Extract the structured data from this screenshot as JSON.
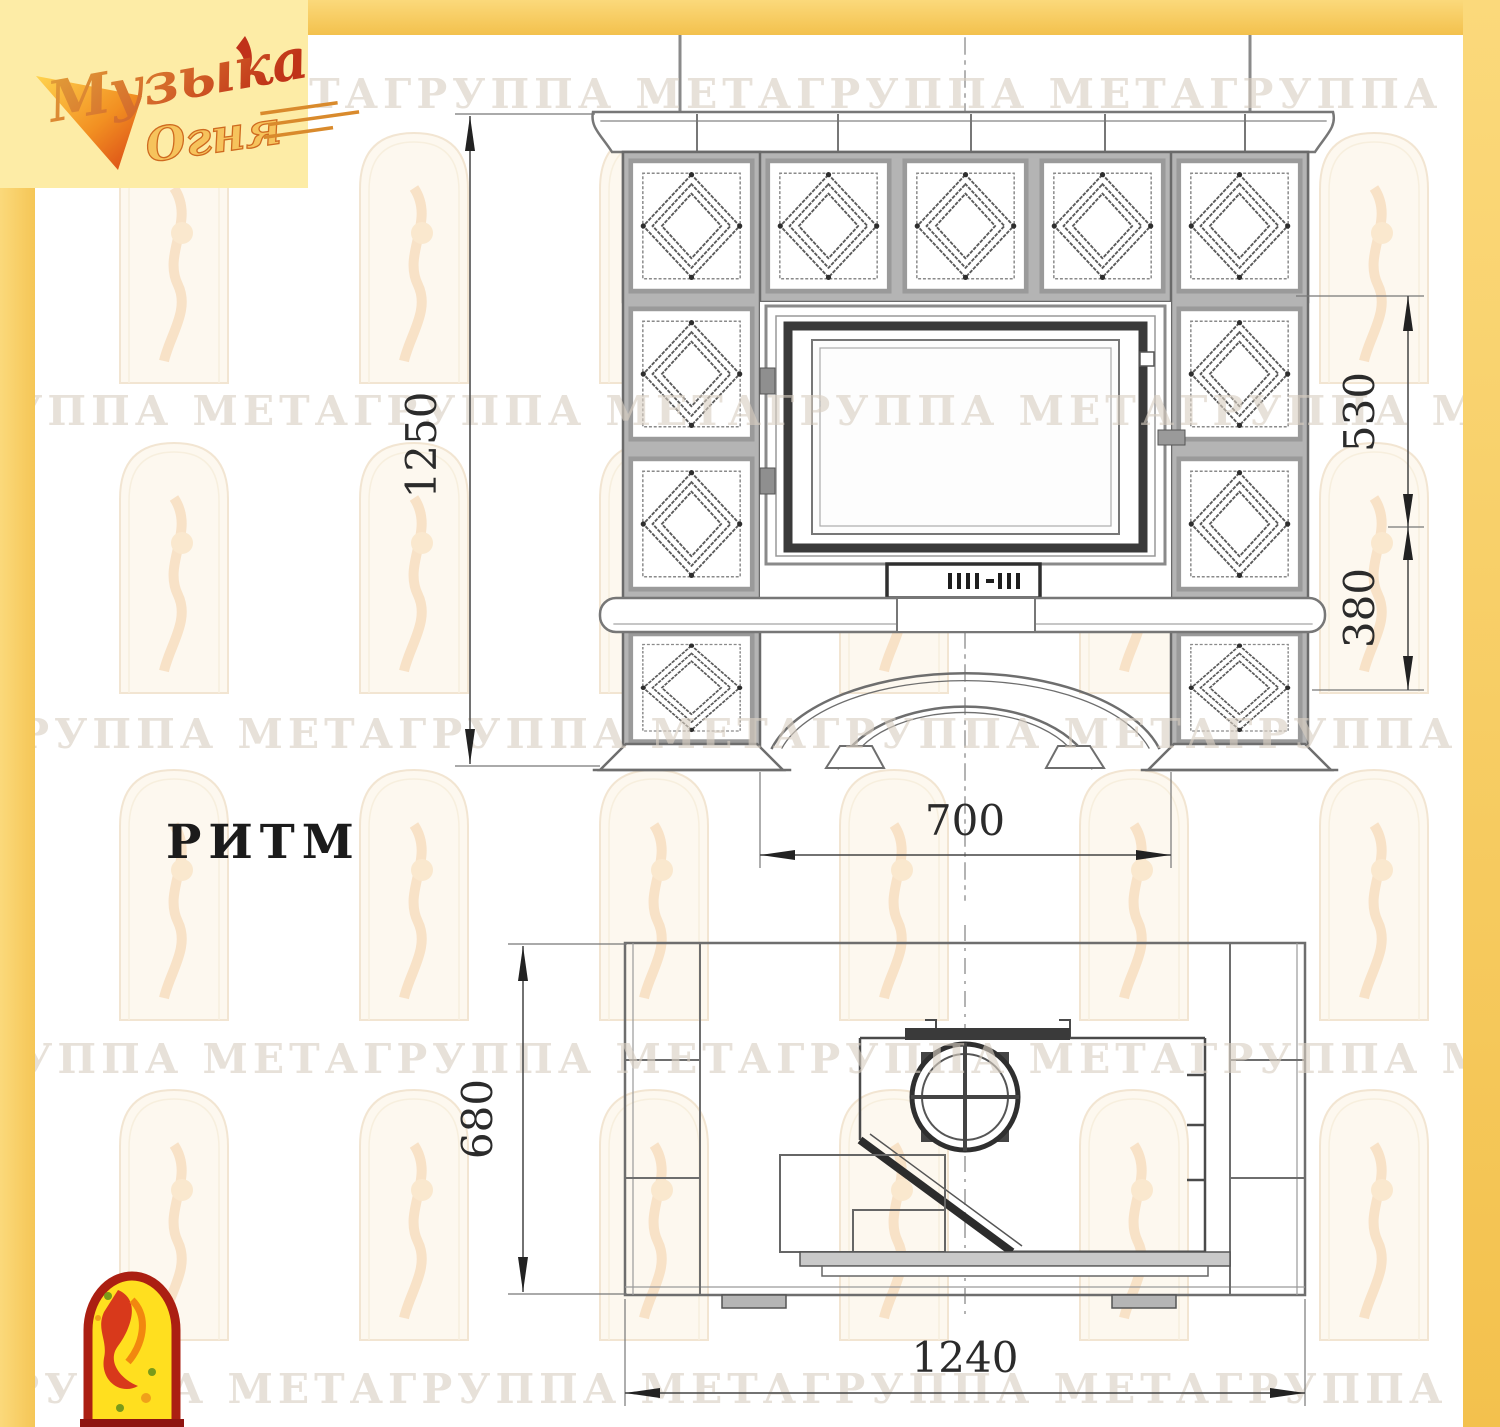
{
  "page": {
    "accent_yellow": "#f8cd5e",
    "logo_background": "#fdeca6",
    "paper": "#ffffff"
  },
  "logo": {
    "word1": "Музыка",
    "word2": "Огня"
  },
  "watermark": {
    "text": "ГРУППА МЕТАГРУППА МЕТАГРУППА МЕТАГРУППА МЕТА",
    "color": "#d9cfc2"
  },
  "title": {
    "label": "РИТМ"
  },
  "drawing": {
    "front_view": {
      "height_mm": "1250",
      "upper_mm": "530",
      "lower_mm": "380",
      "opening_mm": "700"
    },
    "plan_view": {
      "depth_mm": "680",
      "width_mm": "1240"
    }
  },
  "emblem": {
    "border_color": "#ab1f12",
    "fill_color": "#ffdf1f",
    "figure_color": "#d8391b"
  }
}
